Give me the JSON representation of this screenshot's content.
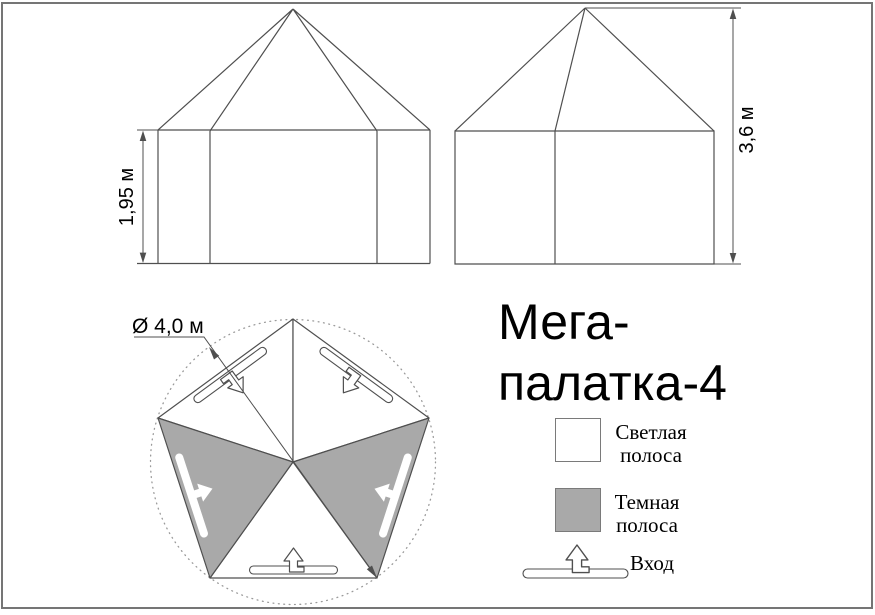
{
  "colors": {
    "line": "#4f4f4f",
    "darkfill": "#a9a9a9",
    "dotted": "#9a9a9a",
    "border": "#757575",
    "text": "#000000",
    "swatchborder": "#7a7a7a"
  },
  "title": {
    "line1": "Мега-",
    "line2": "палатка-4"
  },
  "views": {
    "front": {
      "height_label": "1,95 м"
    },
    "side": {
      "height_label": "3,6 м"
    },
    "plan": {
      "diameter_label": "Ø 4,0 м"
    }
  },
  "legend": {
    "light": {
      "line1": "Светлая",
      "line2": "полоса"
    },
    "dark": {
      "line1": "Темная",
      "line2": "полоса"
    },
    "entrance": {
      "label": "Вход"
    }
  }
}
